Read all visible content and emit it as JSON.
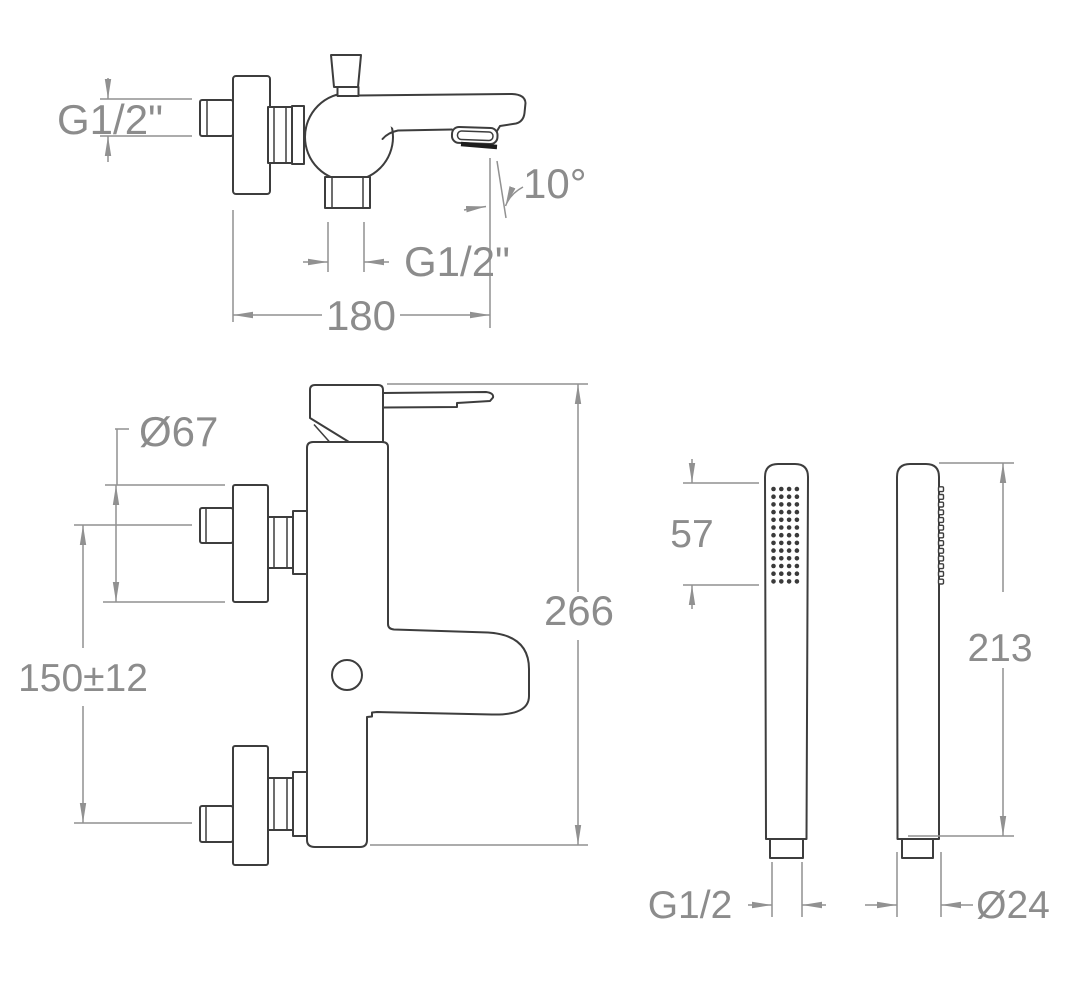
{
  "colors": {
    "outline": "#3d3d3d",
    "dimension": "#919191",
    "label": "#8c8c8c",
    "background": "#ffffff",
    "spray_dot": "#3a3a3a"
  },
  "diagram": {
    "type": "technical-drawing",
    "subject": "wall-mounted bath/shower mixer with handshower, dimensioned views"
  },
  "labels": {
    "mixer_side_inlet_thread": "G1/2\"",
    "mixer_side_spout_angle": "10°",
    "mixer_side_outlet_thread": "G1/2\"",
    "mixer_side_spout_reach": "180",
    "mixer_front_flange_diameter": "Ø67",
    "mixer_front_inlet_spacing": "150±12",
    "mixer_front_total_height": "266",
    "handshower_spray_face_length": "57",
    "handshower_total_length": "213",
    "handshower_inlet_thread": "G1/2",
    "handshower_handle_diameter": "Ø24"
  }
}
